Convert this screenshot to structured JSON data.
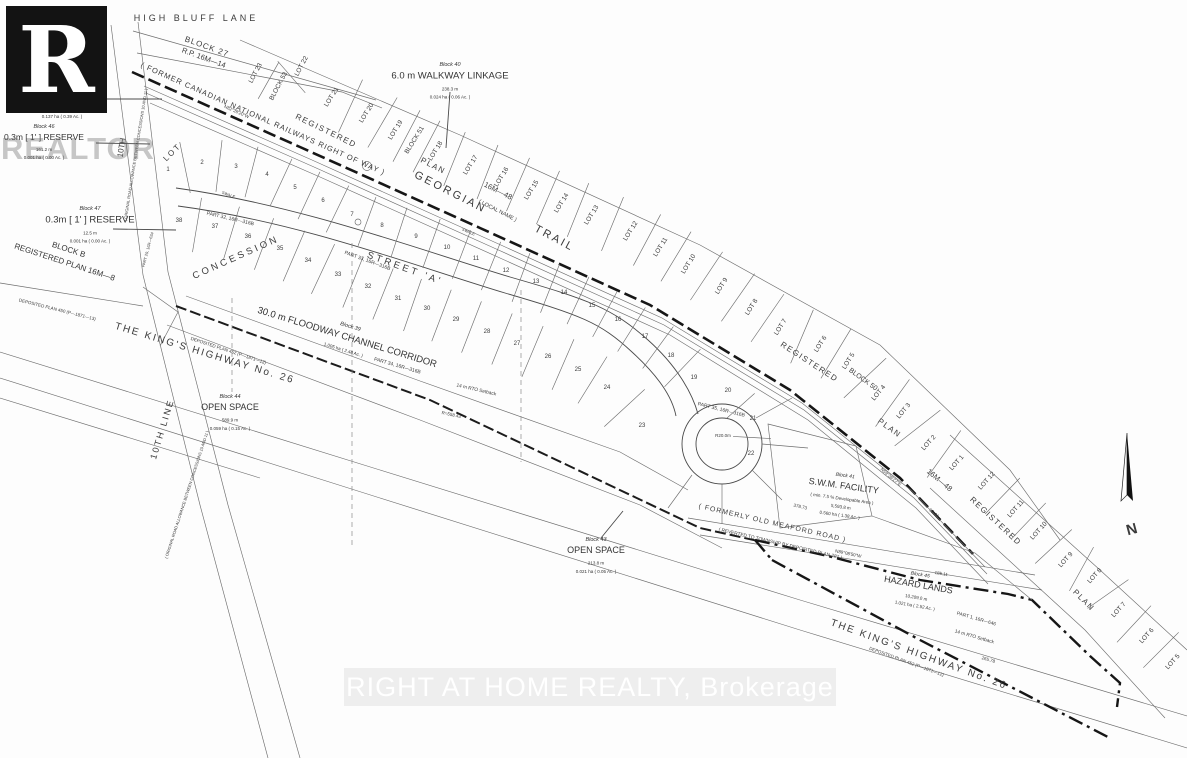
{
  "watermarks": {
    "logo_letter": "R",
    "realtor": "REALTOR",
    "brokerage": "RIGHT AT HOME REALTY, Brokerage"
  },
  "labels": [
    {
      "n": "high-bluff-lane-label",
      "t": "HIGH  BLUFF  LANE",
      "x": 196,
      "y": 21,
      "r": 0,
      "s": 9,
      "sp": 3
    },
    {
      "n": "block-27-label",
      "t": "BLOCK 27",
      "x": 206,
      "y": 49,
      "r": 20,
      "s": 8,
      "sp": 1
    },
    {
      "n": "rp-16m-14-label",
      "t": "R.P. 16M—14",
      "x": 203,
      "y": 60,
      "r": 20,
      "s": 7.5
    },
    {
      "n": "railway-row-label",
      "t": "( FORMER  CANADIAN  NATIONAL  RAILWAYS  RIGHT  OF  WAY )",
      "x": 262,
      "y": 121,
      "r": 24,
      "s": 7.5,
      "sp": 1
    },
    {
      "n": "registered-word-1",
      "t": "REGISTERED",
      "x": 325,
      "y": 133,
      "r": 26,
      "s": 8,
      "sp": 1.5
    },
    {
      "n": "plan-word-1",
      "t": "PLAN",
      "x": 432,
      "y": 168,
      "r": 27,
      "s": 8,
      "sp": 1.5
    },
    {
      "n": "plan-16m48-word-1",
      "t": "16M—48",
      "x": 497,
      "y": 193,
      "r": 27,
      "s": 7.5
    },
    {
      "n": "georgian-label",
      "t": "GEORGIAN",
      "x": 449,
      "y": 195,
      "r": 27,
      "s": 11,
      "sp": 2.5
    },
    {
      "n": "local-name-label",
      "t": "( LOCAL NAME )",
      "x": 497,
      "y": 212,
      "r": 27,
      "s": 5.5
    },
    {
      "n": "trail-label",
      "t": "TRAIL",
      "x": 553,
      "y": 241,
      "r": 28,
      "s": 11,
      "sp": 2.5
    },
    {
      "n": "registered-word-2",
      "t": "REGISTERED",
      "x": 808,
      "y": 364,
      "r": 33,
      "s": 8,
      "sp": 1.5
    },
    {
      "n": "block-50-label",
      "t": "BLOCK 50",
      "x": 862,
      "y": 381,
      "r": 36,
      "s": 7
    },
    {
      "n": "plan-word-2",
      "t": "PLAN",
      "x": 888,
      "y": 430,
      "r": 36,
      "s": 8,
      "sp": 1.5
    },
    {
      "n": "plan-16m48-word-2",
      "t": "16M—48",
      "x": 938,
      "y": 482,
      "r": 40,
      "s": 7.5
    },
    {
      "n": "registered-word-3",
      "t": "REGISTERED",
      "x": 994,
      "y": 523,
      "r": 43,
      "s": 8,
      "sp": 1.5
    },
    {
      "n": "plan-word-3",
      "t": "PLAN",
      "x": 1082,
      "y": 602,
      "r": 45,
      "s": 8,
      "sp": 1.5
    },
    {
      "n": "street-a-label",
      "t": "STREET  'A'",
      "x": 404,
      "y": 271,
      "r": 20,
      "s": 9.5,
      "sp": 3
    },
    {
      "n": "part-33-label",
      "t": "PART 33, 16R—316B",
      "x": 367,
      "y": 262,
      "r": 20,
      "s": 5
    },
    {
      "n": "part-32-label",
      "t": "PART 32, 16R—316B",
      "x": 230,
      "y": 220,
      "r": 13,
      "s": 5
    },
    {
      "n": "part-34-label",
      "t": "PART 34, 16R—316B",
      "x": 397,
      "y": 367,
      "r": 16,
      "s": 5
    },
    {
      "n": "part-35-label",
      "t": "PART 35, 16R—316B",
      "x": 721,
      "y": 411,
      "r": 14,
      "s": 5
    },
    {
      "n": "concession-label",
      "t": "CONCESSION",
      "x": 237,
      "y": 260,
      "r": -24,
      "s": 9.5,
      "sp": 3
    },
    {
      "n": "lot-township-label",
      "t": "LOT",
      "x": 174,
      "y": 154,
      "r": -45,
      "s": 8,
      "sp": 2
    },
    {
      "n": "tenth-line-top-label",
      "t": "10TH",
      "x": 124,
      "y": 148,
      "r": -81,
      "s": 8
    },
    {
      "n": "tenth-line-top-paren",
      "t": "( ORIGINAL ROAD ALLOWANCE BETWEEN CONCESSIONS 10 AND 11 )",
      "x": 137,
      "y": 155,
      "r": -81,
      "s": 4
    },
    {
      "n": "tenth-line-label",
      "t": "10TH   LINE",
      "x": 165,
      "y": 430,
      "r": -73,
      "s": 9,
      "sp": 2
    },
    {
      "n": "tenth-line-paren",
      "t": "( ORIGINAL ROAD ALLOWANCE BETWEEN CONCESSIONS 10 AND 11 )",
      "x": 188,
      "y": 495,
      "r": -72,
      "s": 4
    },
    {
      "n": "part-29-label",
      "t": "PART 29, 16R—634",
      "x": 149,
      "y": 250,
      "r": -75,
      "s": 4
    },
    {
      "n": "kings-highway-left-label",
      "t": "THE   KING'S   HIGHWAY   No.   26",
      "x": 204,
      "y": 356,
      "r": 17,
      "s": 10,
      "sp": 2
    },
    {
      "n": "kings-highway-right-label",
      "t": "THE   KING'S   HIGHWAY   No.   26",
      "x": 918,
      "y": 657,
      "r": 20,
      "s": 10,
      "sp": 2
    },
    {
      "n": "deposited-450-label",
      "t": "DEPOSITED PLAN 450 (P—1871—13)",
      "x": 57,
      "y": 311,
      "r": 14,
      "s": 4.5
    },
    {
      "n": "deposited-452-left-label",
      "t": "DEPOSITED PLAN 452 (P—1871—12)",
      "x": 228,
      "y": 352,
      "r": 18,
      "s": 4.5
    },
    {
      "n": "deposited-452-right-label",
      "t": "DEPOSITED PLAN 452 (P—1871—12)",
      "x": 906,
      "y": 663,
      "r": 20,
      "s": 4.5
    },
    {
      "n": "meaford-road-label",
      "t": "( FORMERLY  OLD  MEAFORD  ROAD )",
      "x": 772,
      "y": 525,
      "r": 13,
      "s": 7,
      "sp": 1
    },
    {
      "n": "meaford-reverted-label",
      "t": "( REVERTED TO TOWNSHIP BY DEPOSITED PLAN 287 )",
      "x": 780,
      "y": 545,
      "r": 13,
      "s": 4.8
    },
    {
      "n": "part-1-16r-646-label",
      "t": "PART 1, 16R—646",
      "x": 976,
      "y": 620,
      "r": 16,
      "s": 4.8
    },
    {
      "n": "rto-setback-right-label",
      "t": "14 m RTO Setback",
      "x": 974,
      "y": 638,
      "r": 16,
      "s": 4.8
    },
    {
      "n": "rto-setback-left-label",
      "t": "14 m RTO Setback",
      "x": 476,
      "y": 391,
      "r": 13,
      "s": 4.8
    },
    {
      "n": "culdesac-radius-label",
      "t": "R20.0m",
      "x": 723,
      "y": 437,
      "r": 0,
      "s": 4.5
    },
    {
      "n": "radius-558-label",
      "t": "R=558.43",
      "x": 451,
      "y": 416,
      "r": 12,
      "s": 4.5
    },
    {
      "n": "bearing-railway",
      "t": "N82°28'20\"W",
      "x": 236,
      "y": 113,
      "r": 24,
      "s": 4.5
    },
    {
      "n": "bearing-hazard-1",
      "t": "N59°36'27\"E",
      "x": 890,
      "y": 478,
      "r": 40,
      "s": 4.5
    },
    {
      "n": "bearing-hazard-2",
      "t": "N89°08'50\"W",
      "x": 848,
      "y": 555,
      "r": 12,
      "s": 4.5
    },
    {
      "n": "dim-378-73",
      "t": "378.73",
      "x": 800,
      "y": 508,
      "r": 13,
      "s": 4.5
    },
    {
      "n": "dim-185-11",
      "t": "185.11",
      "x": 941,
      "y": 575,
      "r": 10,
      "s": 4.5
    },
    {
      "n": "dim-265-78",
      "t": "265.78",
      "x": 988,
      "y": 661,
      "r": 16,
      "s": 4.5
    },
    {
      "n": "dim-99-44",
      "t": "99.44",
      "x": 933,
      "y": 514,
      "r": 40,
      "s": 4.5
    },
    {
      "n": "swale-label-1",
      "t": "SWALE",
      "x": 228,
      "y": 196,
      "r": 21,
      "s": 4
    },
    {
      "n": "swale-label-2",
      "t": "SWALE",
      "x": 468,
      "y": 233,
      "r": 23,
      "s": 4
    },
    {
      "n": "north-label",
      "t": "N",
      "x": 1133,
      "y": 534,
      "r": -15,
      "s": 15,
      "b": 1
    }
  ],
  "lot_groups": [
    {
      "name": "block27-row",
      "r": -62,
      "s": 6.5,
      "div": 42,
      "labels": [
        {
          "t": "LOT 23",
          "x": 257,
          "y": 74
        },
        {
          "t": "BLOCK 53",
          "x": 280,
          "y": 87
        },
        {
          "t": "LOT 22",
          "x": 303,
          "y": 67
        }
      ]
    },
    {
      "name": "registered-plan-16m48-band",
      "r": -58,
      "s": 6.5,
      "div": 58,
      "labels": [
        {
          "t": "LOT 21",
          "x": 333,
          "y": 98
        },
        {
          "t": "LOT 20",
          "x": 368,
          "y": 114
        },
        {
          "t": "LOT 19",
          "x": 397,
          "y": 131
        },
        {
          "t": "BLOCK 51",
          "x": 416,
          "y": 141
        },
        {
          "t": "LOT 18",
          "x": 437,
          "y": 152
        },
        {
          "t": "LOT 17",
          "x": 472,
          "y": 166
        },
        {
          "t": "LOT 16",
          "x": 503,
          "y": 178
        },
        {
          "t": "LOT 15",
          "x": 533,
          "y": 191
        },
        {
          "t": "LOT 14",
          "x": 563,
          "y": 204
        },
        {
          "t": "LOT 13",
          "x": 593,
          "y": 216
        },
        {
          "t": "LOT 12",
          "x": 632,
          "y": 232
        },
        {
          "t": "LOT 11",
          "x": 662,
          "y": 248
        },
        {
          "t": "LOT 10",
          "x": 690,
          "y": 265
        },
        {
          "t": "LOT 9",
          "x": 723,
          "y": 287
        },
        {
          "t": "LOT 8",
          "x": 753,
          "y": 308
        },
        {
          "t": "LOT 7",
          "x": 782,
          "y": 328
        },
        {
          "t": "LOT 6",
          "x": 822,
          "y": 345
        },
        {
          "t": "LOT 5",
          "x": 850,
          "y": 362
        },
        {
          "t": "LOT 4",
          "x": 880,
          "y": 394,
          "r": -50
        },
        {
          "t": "LOT 3",
          "x": 905,
          "y": 412,
          "r": -50
        },
        {
          "t": "LOT 2",
          "x": 930,
          "y": 444,
          "r": -48
        },
        {
          "t": "LOT 1",
          "x": 958,
          "y": 464,
          "r": -48
        }
      ]
    },
    {
      "name": "registered-plan-lower-band",
      "r": -48,
      "s": 6.5,
      "div": 50,
      "labels": [
        {
          "t": "LOT 12",
          "x": 988,
          "y": 482
        },
        {
          "t": "LOT 11",
          "x": 1017,
          "y": 510
        },
        {
          "t": "LOT 10",
          "x": 1040,
          "y": 532
        },
        {
          "t": "LOT 9",
          "x": 1067,
          "y": 561
        },
        {
          "t": "LOT 8",
          "x": 1096,
          "y": 577
        },
        {
          "t": "LOT 7",
          "x": 1120,
          "y": 611
        },
        {
          "t": "LOT 6",
          "x": 1148,
          "y": 637
        },
        {
          "t": "LOT 5",
          "x": 1174,
          "y": 663
        }
      ]
    },
    {
      "name": "street-a-upper-lots",
      "r": 0,
      "s": 6,
      "div": 52,
      "labels": [
        {
          "t": "1",
          "x": 168,
          "y": 171
        },
        {
          "t": "2",
          "x": 202,
          "y": 164
        },
        {
          "t": "3",
          "x": 236,
          "y": 168
        },
        {
          "t": "4",
          "x": 267,
          "y": 176
        },
        {
          "t": "5",
          "x": 295,
          "y": 189
        },
        {
          "t": "6",
          "x": 323,
          "y": 202
        },
        {
          "t": "7",
          "x": 352,
          "y": 216
        },
        {
          "t": "8",
          "x": 382,
          "y": 227
        },
        {
          "t": "9",
          "x": 416,
          "y": 238
        },
        {
          "t": "10",
          "x": 447,
          "y": 249
        },
        {
          "t": "11",
          "x": 476,
          "y": 260
        },
        {
          "t": "12",
          "x": 506,
          "y": 272
        },
        {
          "t": "13",
          "x": 536,
          "y": 283
        },
        {
          "t": "14",
          "x": 564,
          "y": 294
        },
        {
          "t": "15",
          "x": 592,
          "y": 307
        },
        {
          "t": "16",
          "x": 618,
          "y": 321
        },
        {
          "t": "17",
          "x": 645,
          "y": 338
        },
        {
          "t": "18",
          "x": 671,
          "y": 357
        },
        {
          "t": "19",
          "x": 694,
          "y": 379
        }
      ]
    },
    {
      "name": "culdesac-lots",
      "r": 0,
      "s": 6,
      "div": 38,
      "labels": [
        {
          "t": "20",
          "x": 728,
          "y": 392
        },
        {
          "t": "21",
          "x": 753,
          "y": 420
        },
        {
          "t": "22",
          "x": 751,
          "y": 455
        }
      ]
    },
    {
      "name": "street-a-lower-lots",
      "r": 0,
      "s": 6,
      "div": 55,
      "labels": [
        {
          "t": "38",
          "x": 179,
          "y": 222
        },
        {
          "t": "37",
          "x": 215,
          "y": 228
        },
        {
          "t": "36",
          "x": 248,
          "y": 238
        },
        {
          "t": "35",
          "x": 280,
          "y": 250
        },
        {
          "t": "34",
          "x": 308,
          "y": 262
        },
        {
          "t": "33",
          "x": 338,
          "y": 276
        },
        {
          "t": "32",
          "x": 368,
          "y": 288
        },
        {
          "t": "31",
          "x": 398,
          "y": 300
        },
        {
          "t": "30",
          "x": 427,
          "y": 310
        },
        {
          "t": "29",
          "x": 456,
          "y": 321
        },
        {
          "t": "28",
          "x": 487,
          "y": 333
        },
        {
          "t": "27",
          "x": 517,
          "y": 345
        },
        {
          "t": "26",
          "x": 548,
          "y": 358
        },
        {
          "t": "25",
          "x": 578,
          "y": 371
        },
        {
          "t": "24",
          "x": 607,
          "y": 389
        },
        {
          "t": "23",
          "x": 642,
          "y": 427
        }
      ]
    }
  ],
  "notes": [
    {
      "n": "block-42-note",
      "x": 62,
      "y": 86,
      "lines": [
        {
          "t": "Block 42",
          "s": 5.5,
          "i": 1
        },
        {
          "t": "OPEN SPACE",
          "s": 9
        },
        {
          "t": "1,373.9 m",
          "s": 4.5
        },
        {
          "t": "0.137 ha ( 0.39 Ac. )",
          "s": 4.5
        }
      ]
    },
    {
      "n": "block-46-note",
      "x": 44,
      "y": 128,
      "lines": [
        {
          "t": "Block 46",
          "s": 5.5,
          "i": 1
        },
        {
          "t": "0.3m [ 1' ] RESERVE",
          "s": 8.5
        },
        {
          "t": "161.2 m",
          "s": 4.5
        },
        {
          "t": "0.001 ha ( 0.00 Ac. )",
          "s": 4.5
        }
      ]
    },
    {
      "n": "block-40-note",
      "x": 450,
      "y": 66,
      "lines": [
        {
          "t": "Block 40",
          "s": 5.5,
          "i": 1
        },
        {
          "t": "6.0 m WALKWAY LINKAGE",
          "s": 9.5
        },
        {
          "t": "238.3 m",
          "s": 4.5
        },
        {
          "t": "0.024 ha ( 0.06 Ac. )",
          "s": 4.5
        }
      ]
    },
    {
      "n": "block-47-note",
      "x": 90,
      "y": 210,
      "lines": [
        {
          "t": "Block 47",
          "s": 5.5,
          "i": 1
        },
        {
          "t": "0.3m [ 1' ] RESERVE",
          "s": 9.5
        },
        {
          "t": "12.5 m",
          "s": 4.5
        },
        {
          "t": "0.001 ha ( 0.00 Ac. )",
          "s": 4.5
        }
      ]
    },
    {
      "n": "block-b-note",
      "x": 68,
      "y": 252,
      "r": 18,
      "lines": [
        {
          "t": "BLOCK  B",
          "s": 8
        },
        {
          "t": "REGISTERED  PLAN  16M—8",
          "s": 8
        }
      ]
    },
    {
      "n": "block-39-floodway-note",
      "x": 350,
      "y": 328,
      "r": 17,
      "lines": [
        {
          "t": "Block 39",
          "s": 5.5,
          "i": 1
        },
        {
          "t": "30.0 m FLOODWAY CHANNEL CORRIDOR",
          "s": 9.5
        },
        {
          "t": "1.005 ha ( 2.48 Ac. )",
          "s": 4.5
        }
      ]
    },
    {
      "n": "block-44-note",
      "x": 230,
      "y": 398,
      "lines": [
        {
          "t": "Block 44",
          "s": 5.5,
          "i": 1
        },
        {
          "t": "OPEN SPACE",
          "s": 9
        },
        {
          "t": "589.9 m",
          "s": 4.5
        },
        {
          "t": "0.059 ha ( 0.15 Ac. )",
          "s": 4.5
        }
      ]
    },
    {
      "n": "block-41-swm-note",
      "x": 845,
      "y": 477,
      "r": 8,
      "lines": [
        {
          "t": "Block 41",
          "s": 5,
          "i": 1
        },
        {
          "t": "S.W.M. FACILITY",
          "s": 9
        },
        {
          "t": "( min. 7.5 % Developable Area )",
          "s": 4.5
        },
        {
          "t": "5,593.8 m",
          "s": 4.5
        },
        {
          "t": "0.560 ha ( 1.38 Ac. )",
          "s": 4.5
        }
      ]
    },
    {
      "n": "block-43-note",
      "x": 596,
      "y": 541,
      "lines": [
        {
          "t": "Block 43",
          "s": 5.5,
          "i": 1
        },
        {
          "t": "OPEN SPACE",
          "s": 9
        },
        {
          "t": "213.8 m",
          "s": 4.5
        },
        {
          "t": "0.021 ha ( 0.05 Ac. )",
          "s": 4.5
        }
      ]
    },
    {
      "n": "block-45-note",
      "x": 920,
      "y": 576,
      "r": 10,
      "lines": [
        {
          "t": "Block 45",
          "s": 5,
          "i": 1
        },
        {
          "t": "HAZARD LANDS",
          "s": 9
        },
        {
          "t": "10,209.0 m",
          "s": 4.5
        },
        {
          "t": "1.021 ha ( 2.52 Ac. )",
          "s": 4.5
        }
      ]
    }
  ]
}
